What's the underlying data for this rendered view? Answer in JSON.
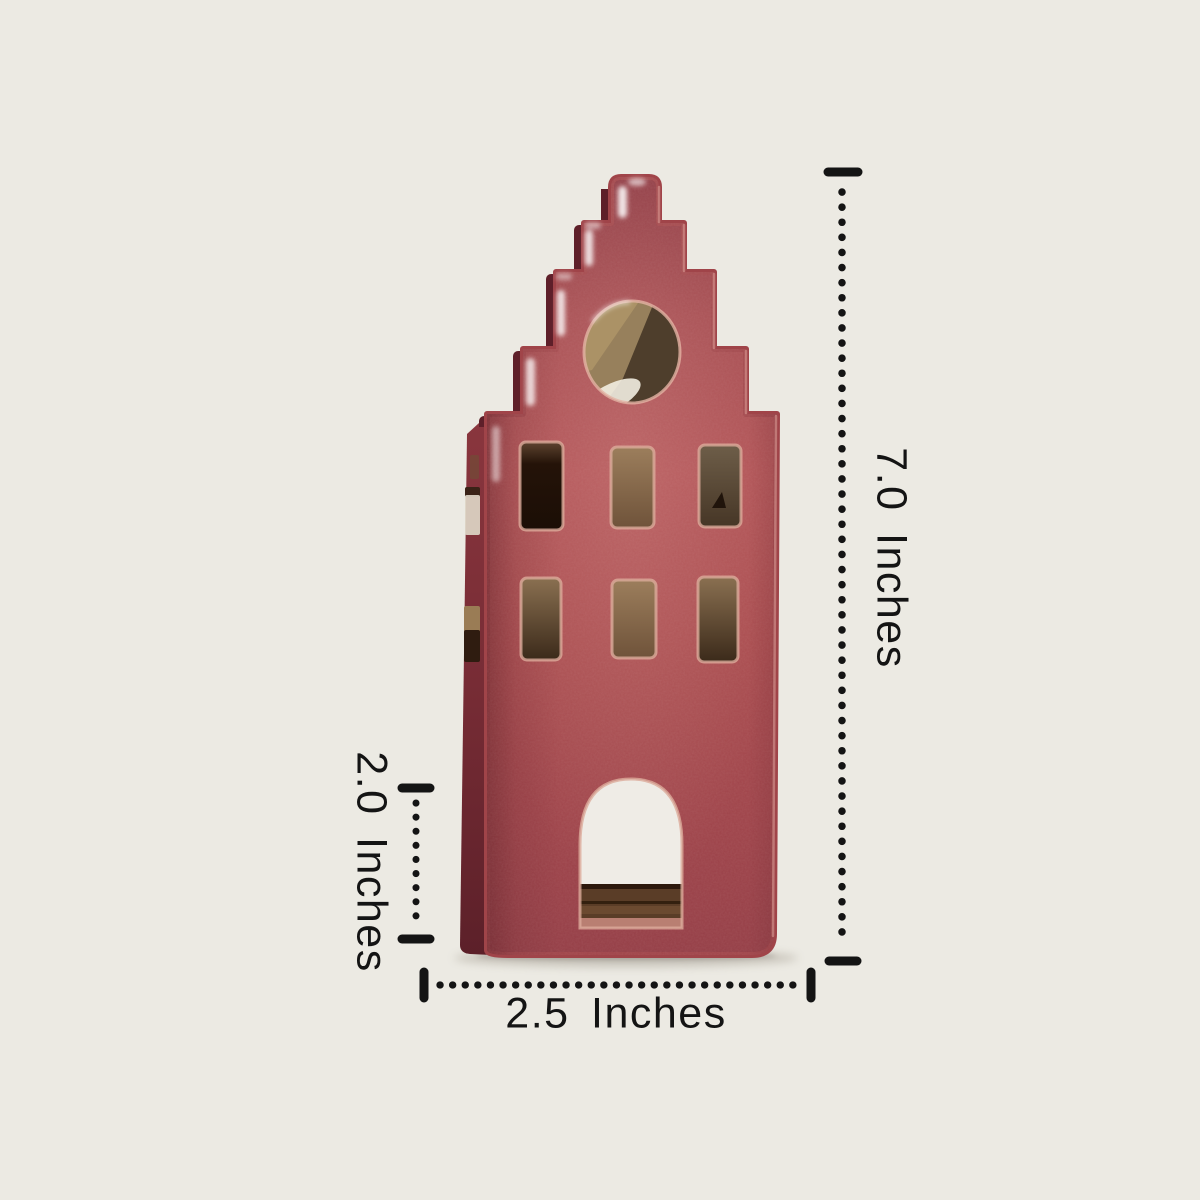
{
  "figure": {
    "subject": "red-ceramic-stepped-gable-house-tealight-holder",
    "background_color": "#ECEAE3",
    "annotation_color": "#141414",
    "house_colors": {
      "glaze_red": "#A84B4E",
      "glaze_red_light": "#B25154",
      "glaze_red_dark": "#8F3B44",
      "side_face_shadow": "#6E2931",
      "rim_highlight": "#DCAB9B",
      "interior_tan": "#96785C",
      "interior_dark_brown": "#241308",
      "wood_base": "#5A3D27",
      "see_through_light": "#EFECE6"
    },
    "dimensions": {
      "height_label": "7.0 Inches",
      "lower_section_label": "2.0 Inches",
      "width_label": "2.5 Inches"
    }
  }
}
